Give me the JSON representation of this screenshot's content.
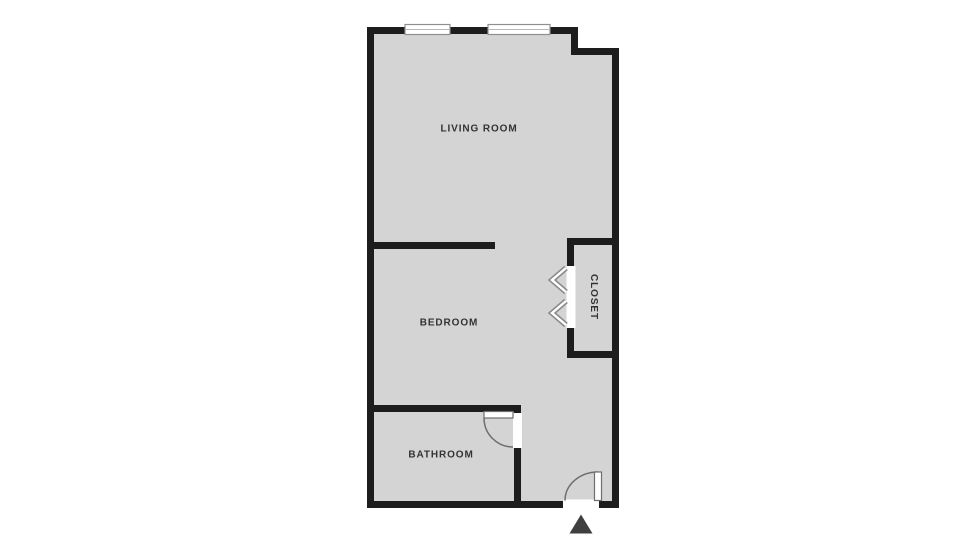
{
  "plan": {
    "type": "apartment-floor-plan",
    "rooms": [
      {
        "id": "living-room",
        "label": "LIVING ROOM"
      },
      {
        "id": "bedroom",
        "label": "BEDROOM"
      },
      {
        "id": "bathroom",
        "label": "BATHROOM"
      },
      {
        "id": "closet",
        "label": "CLOSET"
      }
    ],
    "features": {
      "windows_count": "2",
      "doors": [
        "bathroom-swing-door",
        "entrance-swing-door",
        "closet-bifold-doors"
      ],
      "entrance_marker": "triangle-up"
    }
  },
  "colors": {
    "background": "#ffffff",
    "floor": "#d4d4d4",
    "wall": "#1d1d1d",
    "opening": "#ffffff",
    "door_stroke": "#6e6e6e",
    "window_border": "#8f8f8f",
    "window_midline": "#b9b9b9",
    "bifold_outline": "#8a8a8a",
    "bifold_inner": "#ffffff",
    "label": "#333333",
    "entrance_marker": "#3f3f3f"
  }
}
